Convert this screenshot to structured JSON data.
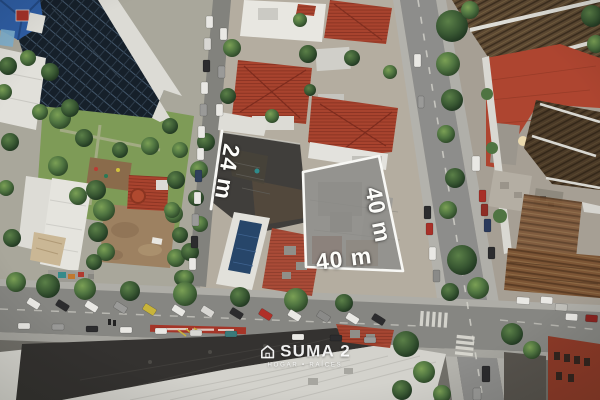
{
  "photo": {
    "kind": "aerial-drone-view",
    "subject": "urban corner lot outlined for sale"
  },
  "lot": {
    "outline_color": "#f8f8f5",
    "overlay_color": "#8c8b88",
    "dimensions": {
      "left_side": "24 m",
      "right_side": "40 m",
      "bottom_side": "40 m"
    }
  },
  "watermark": {
    "icon": "house-icon",
    "brand": "SUMA 2",
    "tagline": "HOGAR • RAÍCES",
    "text_color": "#ffffff"
  }
}
